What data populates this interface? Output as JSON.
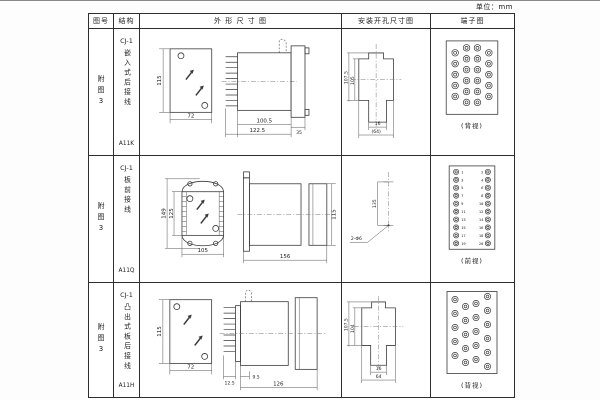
{
  "unit_label": "单位：mm",
  "table": {
    "headers": [
      "图号",
      "结构",
      "外 形 尺 寸 图",
      "安装开孔尺寸图",
      "端子图"
    ]
  },
  "rows": [
    {
      "fig_no": "附图3",
      "structure": {
        "model": "CJ-1",
        "desc": "嵌入式后接线",
        "code": "A11K"
      },
      "outline": {
        "front_height": "115",
        "front_width": "72",
        "body_len": "100.5",
        "total_len": "122.5",
        "flange_len": "35"
      },
      "install": {
        "v_outer": "107.5",
        "v_inner": "105",
        "h_inner": "16",
        "h_outer": "(64)"
      },
      "terminal": {
        "view_label": "(背视)"
      }
    },
    {
      "fig_no": "附图3",
      "structure": {
        "model": "CJ-1",
        "desc": "板前接线",
        "code": "A11Q"
      },
      "outline": {
        "outer_height": "149",
        "inner_height": "125",
        "front_width": "105",
        "side_len": "156",
        "side_height": "115"
      },
      "install": {
        "v_dim": "135",
        "hole_label": "2-Φ6"
      },
      "terminal": {
        "view_label": "(前视)",
        "left_numbers": [
          "1",
          "3",
          "5",
          "7",
          "9",
          "11",
          "13",
          "15",
          "17",
          "19"
        ],
        "right_numbers": [
          "2",
          "4",
          "6",
          "8",
          "10",
          "12",
          "14",
          "16",
          "18",
          "20"
        ]
      }
    },
    {
      "fig_no": "附图3",
      "structure": {
        "model": "CJ-1",
        "desc": "凸出式板后接线",
        "code": "A11H"
      },
      "outline": {
        "front_height": "115",
        "front_width": "72",
        "pin_len": "12.5",
        "offset": "9.5",
        "body_len": "126"
      },
      "install": {
        "v_outer": "107.5",
        "v_inner": "104",
        "h_inner": "16",
        "h_outer": "64"
      },
      "terminal": {
        "view_label": "(背视)"
      }
    }
  ]
}
